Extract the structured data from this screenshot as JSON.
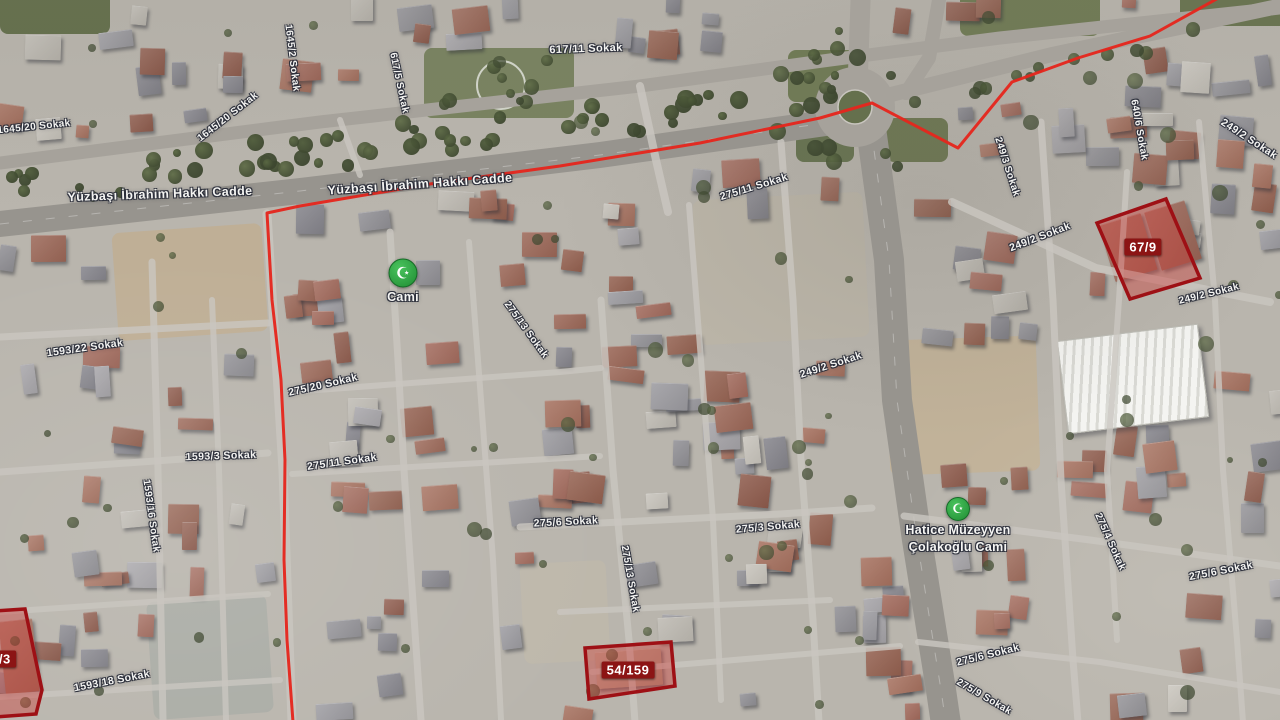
{
  "map": {
    "view": "satellite",
    "colors": {
      "terrain_base": "#b9b5ad",
      "road": "#a6a29b",
      "road_major": "#97948e",
      "road_thin": "#c9c6bf",
      "boundary_red": "#e5261d",
      "parcel_stroke": "#9e1015",
      "parcel_fill": "rgba(205,60,55,0.42)",
      "chip_bg": "#8c1414",
      "chip_text": "#ffffff",
      "mosque_green": "#2da244",
      "veg_dark": "#4f5c3b"
    },
    "street_labels": [
      {
        "text": "Yüzbaşı İbrahim Hakkı Cadde",
        "x": 160,
        "y": 194,
        "rot": -2,
        "size": 12.5
      },
      {
        "text": "Yüzbaşı İbrahim Hakkı Cadde",
        "x": 420,
        "y": 184,
        "rot": -4,
        "size": 12.5
      },
      {
        "text": "617/11 Sokak",
        "x": 586,
        "y": 49,
        "rot": -2,
        "size": 11
      },
      {
        "text": "617/5 Sokak",
        "x": 399,
        "y": 83,
        "rot": 78,
        "size": 10
      },
      {
        "text": "1645/20 Sokak",
        "x": 228,
        "y": 117,
        "rot": -38,
        "size": 10
      },
      {
        "text": "1645/20 Sokak",
        "x": 34,
        "y": 127,
        "rot": -6,
        "size": 10
      },
      {
        "text": "1645/2 Sokak",
        "x": 292,
        "y": 58,
        "rot": 83,
        "size": 10
      },
      {
        "text": "1593/22 Sokak",
        "x": 85,
        "y": 348,
        "rot": -8,
        "size": 10.5
      },
      {
        "text": "1593/3 Sokak",
        "x": 221,
        "y": 456,
        "rot": -2,
        "size": 10.5
      },
      {
        "text": "1593/16 Sokak",
        "x": 151,
        "y": 516,
        "rot": 82,
        "size": 10
      },
      {
        "text": "1593/18 Sokak",
        "x": 112,
        "y": 681,
        "rot": -11,
        "size": 10.5
      },
      {
        "text": "275/20 Sokak",
        "x": 323,
        "y": 385,
        "rot": -13,
        "size": 10.5
      },
      {
        "text": "275/11 Sokak",
        "x": 342,
        "y": 462,
        "rot": -8,
        "size": 10.5
      },
      {
        "text": "275/13 Sokak",
        "x": 526,
        "y": 330,
        "rot": 54,
        "size": 10
      },
      {
        "text": "275/6 Sokak",
        "x": 566,
        "y": 522,
        "rot": -3,
        "size": 10.5
      },
      {
        "text": "275/13 Sokak",
        "x": 630,
        "y": 579,
        "rot": 80,
        "size": 10
      },
      {
        "text": "275/11 Sokak",
        "x": 754,
        "y": 187,
        "rot": -17,
        "size": 10.5
      },
      {
        "text": "249/2 Sokak",
        "x": 831,
        "y": 365,
        "rot": -18,
        "size": 10.5
      },
      {
        "text": "275/3 Sokak",
        "x": 768,
        "y": 527,
        "rot": -5,
        "size": 10.5
      },
      {
        "text": "249/3 Sokak",
        "x": 1007,
        "y": 167,
        "rot": 72,
        "size": 10
      },
      {
        "text": "249/2 Sokak",
        "x": 1040,
        "y": 237,
        "rot": -21,
        "size": 10.5
      },
      {
        "text": "640/6 Sokak",
        "x": 1139,
        "y": 130,
        "rot": 80,
        "size": 10
      },
      {
        "text": "249/2 Sokak",
        "x": 1249,
        "y": 139,
        "rot": 33,
        "size": 10.5
      },
      {
        "text": "249/2 Sokak",
        "x": 1209,
        "y": 294,
        "rot": -14,
        "size": 10
      },
      {
        "text": "275/4 Sokak",
        "x": 1110,
        "y": 542,
        "rot": 66,
        "size": 10
      },
      {
        "text": "275/6 Sokak",
        "x": 1221,
        "y": 571,
        "rot": -11,
        "size": 10.5
      },
      {
        "text": "275/6 Sokak",
        "x": 988,
        "y": 655,
        "rot": -14,
        "size": 10.5
      },
      {
        "text": "275/9 Sokak",
        "x": 984,
        "y": 697,
        "rot": 30,
        "size": 10
      }
    ],
    "poi_markers": [
      {
        "name": "Cami",
        "symbol": "☪",
        "x": 403,
        "y": 273,
        "size": 27,
        "label_lines": [
          "Cami"
        ]
      },
      {
        "name": "Hatice Müzeyyen Çolakoğlu Cami",
        "symbol": "☪",
        "x": 958,
        "y": 509,
        "size": 22,
        "label_lines": [
          "Hatice Müzeyyen",
          "Çolakoğlu Cami"
        ]
      }
    ],
    "parcels": [
      {
        "label": "67/9",
        "points": "1097,223 1166,199 1200,278 1130,299",
        "label_x": 1143,
        "label_y": 247
      },
      {
        "label": "54/159",
        "points": "585,648 671,642 675,686 589,699",
        "label_x": 628,
        "label_y": 670
      },
      {
        "label": "2/3",
        "points": "-20,612 25,609 42,690 36,714 -20,718",
        "label_x": 1,
        "label_y": 659
      }
    ],
    "boundary": {
      "points": "1222,-4 1150,36 1078,58 1012,82 958,148 872,103 820,118 700,143 560,166 430,184 300,206 267,213 272,300 281,380 285,460 284,560 287,640 293,722",
      "width": 3
    },
    "roads": [
      {
        "pts": "0,224 300,191 600,155 875,116",
        "w": 26,
        "k": "major"
      },
      {
        "pts": "0,163 320,122 640,86 830,60 1000,38 1280,8",
        "w": 13,
        "k": "std"
      },
      {
        "pts": "885,96 1050,55 1280,6",
        "w": 15,
        "k": "std"
      },
      {
        "pts": "858,72 861,-12",
        "w": 20,
        "k": "std"
      },
      {
        "pts": "940,-6 929,58 906,93",
        "w": 14,
        "k": "std"
      },
      {
        "pts": "871,128 889,260 897,400 917,540 941,690 946,724",
        "w": 30,
        "k": "major"
      },
      {
        "pts": "152,262 158,470 163,720",
        "w": 7,
        "k": "thin"
      },
      {
        "pts": "212,300 219,470 226,720",
        "w": 6,
        "k": "thin"
      },
      {
        "pts": "267,214 283,470 292,722",
        "w": 9,
        "k": "thin"
      },
      {
        "pts": "390,232 398,360 404,470 421,720",
        "w": 7,
        "k": "thin"
      },
      {
        "pts": "469,242 481,400 493,560 501,720",
        "w": 6,
        "k": "thin"
      },
      {
        "pts": "601,300 613,470 629,640 635,722",
        "w": 7,
        "k": "thin"
      },
      {
        "pts": "689,205 701,360 713,520 721,700",
        "w": 6,
        "k": "thin"
      },
      {
        "pts": "781,142 793,300 801,460 813,620 819,722",
        "w": 7,
        "k": "thin"
      },
      {
        "pts": "1041,122 1053,300 1061,480 1073,660 1078,722",
        "w": 7,
        "k": "thin"
      },
      {
        "pts": "1127,172 1119,300 1107,470 1117,640",
        "w": 6,
        "k": "thin"
      },
      {
        "pts": "1199,122 1215,300 1223,470 1237,640 1243,722",
        "w": 6,
        "k": "thin"
      },
      {
        "pts": "0,337 268,323",
        "w": 7,
        "k": "thin"
      },
      {
        "pts": "0,472 268,453",
        "w": 7,
        "k": "thin"
      },
      {
        "pts": "0,612 268,594",
        "w": 6,
        "k": "thin"
      },
      {
        "pts": "0,697 280,680",
        "w": 6,
        "k": "thin"
      },
      {
        "pts": "290,392 560,372 601,368",
        "w": 6,
        "k": "thin"
      },
      {
        "pts": "292,474 600,456",
        "w": 6,
        "k": "thin"
      },
      {
        "pts": "520,527 780,514 872,508",
        "w": 7,
        "k": "thin"
      },
      {
        "pts": "560,612 830,600",
        "w": 6,
        "k": "thin"
      },
      {
        "pts": "592,672 900,646",
        "w": 6,
        "k": "thin"
      },
      {
        "pts": "904,516 1090,540 1280,566",
        "w": 7,
        "k": "thin"
      },
      {
        "pts": "918,642 1100,662 1280,692",
        "w": 6,
        "k": "thin"
      },
      {
        "pts": "952,202 1096,268 1270,302",
        "w": 8,
        "k": "thin"
      },
      {
        "pts": "640,86 656,160 668,212",
        "w": 8,
        "k": "thin"
      },
      {
        "pts": "340,120 360,175",
        "w": 6,
        "k": "thin"
      }
    ],
    "terrain": {
      "roundabout": {
        "cx": 855,
        "cy": 107,
        "r_outer": 40,
        "r_inner": 17
      },
      "green_patches": [
        {
          "x": 788,
          "y": 50,
          "w": 78,
          "h": 52,
          "c": "#6c784f"
        },
        {
          "x": 886,
          "y": 118,
          "w": 62,
          "h": 44,
          "c": "#68744c"
        },
        {
          "x": 796,
          "y": 122,
          "w": 58,
          "h": 40,
          "c": "#61704a"
        },
        {
          "x": 424,
          "y": 48,
          "w": 150,
          "h": 70,
          "c": "#76815c",
          "ring": true
        },
        {
          "x": 960,
          "y": -10,
          "w": 140,
          "h": 46,
          "c": "#6c784f"
        },
        {
          "x": 1180,
          "y": -14,
          "w": 120,
          "h": 40,
          "c": "#64714b"
        },
        {
          "x": 0,
          "y": -8,
          "w": 110,
          "h": 42,
          "c": "#5f6c47"
        }
      ],
      "dirt_lots": [
        {
          "x": 115,
          "y": 228,
          "w": 150,
          "h": 108,
          "rot": -4,
          "c": "#c0ae93"
        },
        {
          "x": 696,
          "y": 196,
          "w": 170,
          "h": 145,
          "rot": -3,
          "c": "#bdb6a9"
        },
        {
          "x": 888,
          "y": 338,
          "w": 150,
          "h": 135,
          "rot": -2,
          "c": "#c2b197"
        },
        {
          "x": 522,
          "y": 562,
          "w": 86,
          "h": 100,
          "rot": -3,
          "c": "#bfb8ab"
        },
        {
          "x": 150,
          "y": 598,
          "w": 120,
          "h": 118,
          "rot": -4,
          "c": "#a9aba4"
        }
      ],
      "white_building": {
        "x": 1062,
        "y": 332,
        "w": 140,
        "h": 92,
        "rot": -7
      },
      "fixed_buildings": [
        {
          "x": 1106,
          "y": 218,
          "w": 44,
          "h": 58,
          "rot": -17,
          "c": "#a06a5a"
        },
        {
          "x": 1152,
          "y": 205,
          "w": 42,
          "h": 60,
          "rot": -17,
          "c": "#9a6455"
        },
        {
          "x": 596,
          "y": 650,
          "w": 66,
          "h": 36,
          "rot": -4,
          "c": "#b3a08c"
        },
        {
          "x": 2,
          "y": 620,
          "w": 34,
          "h": 72,
          "rot": -6,
          "c": "#9c6a58"
        }
      ]
    }
  }
}
